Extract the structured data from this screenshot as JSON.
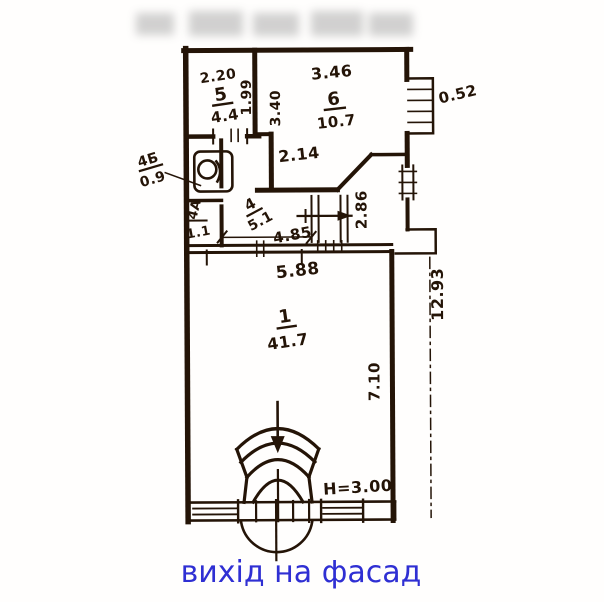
{
  "caption": {
    "text": "вихід на фасад"
  },
  "rooms": {
    "r5": {
      "number": "5",
      "area": "4.4"
    },
    "r6": {
      "number": "6",
      "area": "10.7"
    },
    "r4": {
      "number": "4",
      "area": "5.1"
    },
    "r4a": {
      "number": "4А",
      "area": "1.1"
    },
    "r4b": {
      "number": "4Б",
      "area": "0.9"
    },
    "r1": {
      "number": "1",
      "area": "41.7"
    }
  },
  "dims": {
    "room5_top": "2.20",
    "room5_side": "1.99",
    "room6_top": "3.46",
    "room6_side": "3.40",
    "facade_ledge": "0.52",
    "mid_wall": "2.14",
    "right_niche": "2.86",
    "corridor": "4.85",
    "room1_width": "5.88",
    "building_depth": "12.93",
    "room1_depth": "7.10",
    "ceiling_height": "H=3.00"
  },
  "colors": {
    "ink": "#241407",
    "caption_blue": "#2f2fd3"
  }
}
